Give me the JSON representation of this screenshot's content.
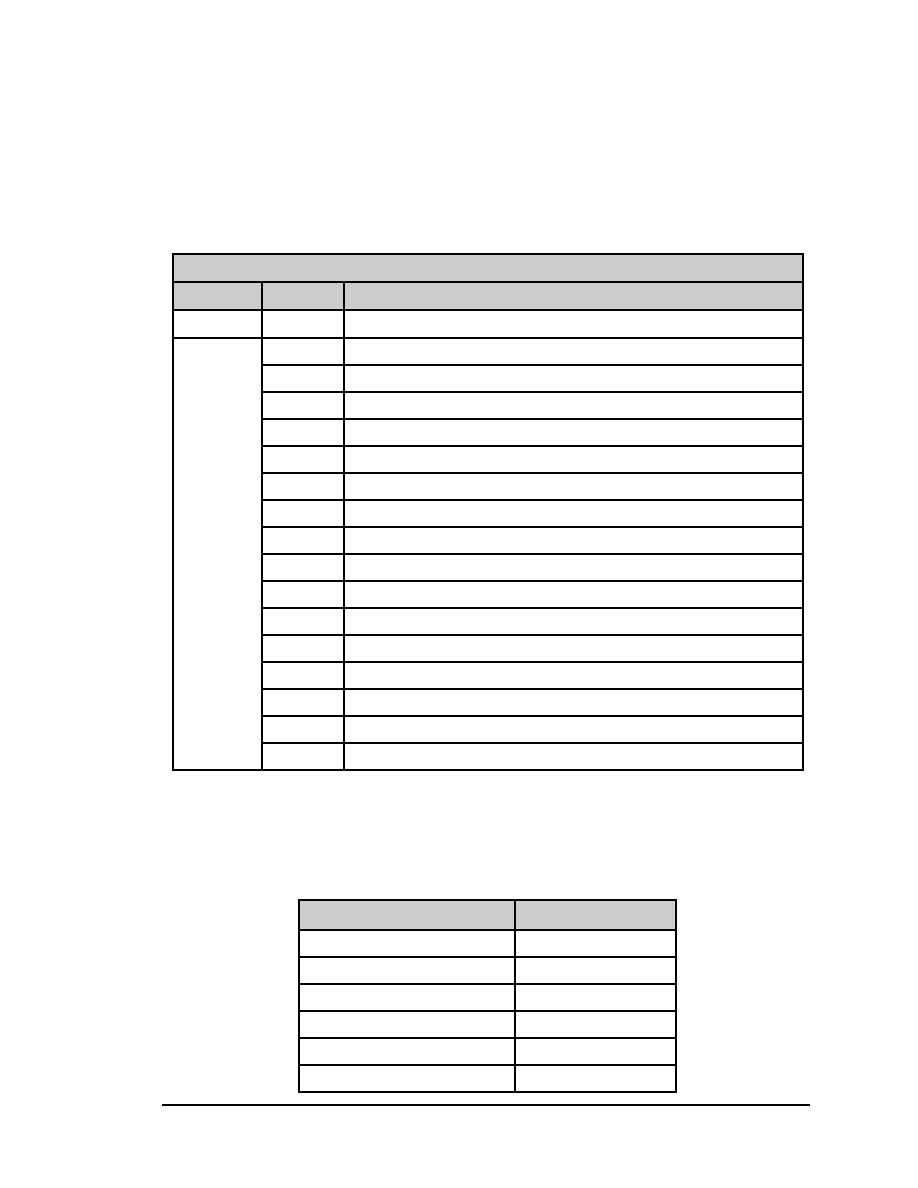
{
  "page": {
    "background": "#ffffff"
  },
  "colors": {
    "header_fill": "#cccccc",
    "border": "#000000",
    "rule_color": "#000000"
  },
  "main_table": {
    "title_row": [
      ""
    ],
    "header_row": [
      "",
      "",
      ""
    ],
    "first_row": [
      "",
      "",
      ""
    ],
    "merged_cell": "",
    "body_rows": [
      [
        "",
        ""
      ],
      [
        "",
        ""
      ],
      [
        "",
        ""
      ],
      [
        "",
        ""
      ],
      [
        "",
        ""
      ],
      [
        "",
        ""
      ],
      [
        "",
        ""
      ],
      [
        "",
        ""
      ],
      [
        "",
        ""
      ],
      [
        "",
        ""
      ],
      [
        "",
        ""
      ],
      [
        "",
        ""
      ],
      [
        "",
        ""
      ],
      [
        "",
        ""
      ],
      [
        "",
        ""
      ],
      [
        "",
        ""
      ]
    ],
    "column_widths_px": [
      89,
      82,
      459
    ],
    "row_heights_px": {
      "title": 28,
      "header": 28,
      "first": 28,
      "body": 27
    }
  },
  "secondary_table": {
    "header_row": [
      "",
      ""
    ],
    "body_rows": [
      [
        "",
        ""
      ],
      [
        "",
        ""
      ],
      [
        "",
        ""
      ],
      [
        "",
        ""
      ],
      [
        "",
        ""
      ],
      [
        "",
        ""
      ]
    ],
    "column_widths_px": [
      216,
      161
    ],
    "row_heights_px": {
      "header": 30,
      "body": 27
    }
  }
}
